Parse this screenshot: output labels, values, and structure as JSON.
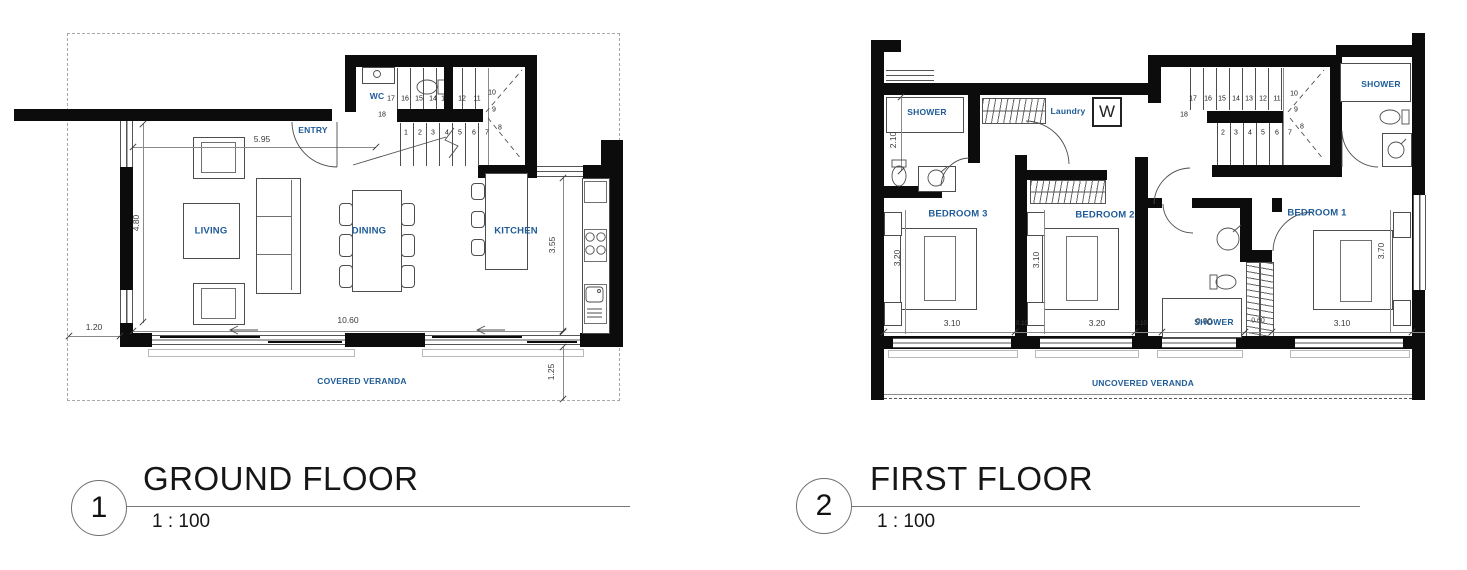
{
  "colors": {
    "label_blue": "#1e5b97",
    "wall": "#0c0c0c",
    "line": "#4d4d4d",
    "dim_text": "#3b3b3b",
    "boundary_dash": "#a8a8a8"
  },
  "gf": {
    "title": {
      "num": "1",
      "name": "GROUND FLOOR",
      "scale": "1 : 100"
    },
    "rooms": {
      "living": "LIVING",
      "dining": "DINING",
      "kitchen": "KITCHEN",
      "entry": "ENTRY",
      "wc": "WC",
      "veranda": "COVERED VERANDA"
    },
    "dims": {
      "top": "5.95",
      "left": "4.80",
      "left_off": "1.20",
      "bottom": "10.60",
      "right": "3.55",
      "right_off": "1.25"
    },
    "stairs": {
      "top": [
        "17",
        "16",
        "15",
        "14",
        "13",
        "12",
        "11"
      ],
      "winder": [
        "10",
        "9",
        "8"
      ],
      "bottom": [
        "1",
        "2",
        "3",
        "4",
        "5",
        "6",
        "7"
      ],
      "mid": "18"
    }
  },
  "ff": {
    "title": {
      "num": "2",
      "name": "FIRST FLOOR",
      "scale": "1 : 100"
    },
    "rooms": {
      "shower_left": "SHOWER",
      "shower_right": "SHOWER",
      "shower_mid": "SHOWER",
      "laundry": "Laundry",
      "laundry_symbol": "W",
      "bed3": "BEDROOM 3",
      "bed2": "BEDROOM 2",
      "bed1": "BEDROOM 1",
      "veranda": "UNCOVERED VERANDA"
    },
    "dims": {
      "shower_left_v": "2.10",
      "bed3_v": "3.20",
      "bed2_v": "3.10",
      "bed1_v": "3.70",
      "bed3_w": "3.10",
      "bed2_w": "3.20",
      "bed1_w": "3.10",
      "shower_w": "0.90",
      "closet_w": "0.60",
      "pier": "0.10"
    },
    "stairs": {
      "top": [
        "17",
        "16",
        "15",
        "14",
        "13",
        "12",
        "11"
      ],
      "winder": [
        "10",
        "9",
        "8"
      ],
      "bottom": [
        "2",
        "3",
        "4",
        "5",
        "6",
        "7"
      ],
      "mid": "18"
    }
  }
}
